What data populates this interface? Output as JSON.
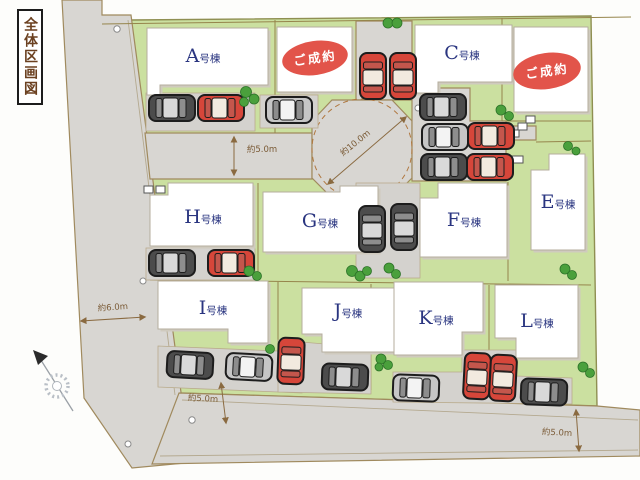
{
  "title": "全体区画図",
  "buildings": [
    {
      "letter": "A",
      "suffix": "号棟"
    },
    {
      "letter": "C",
      "suffix": "号棟"
    },
    {
      "letter": "E",
      "suffix": "号棟"
    },
    {
      "letter": "F",
      "suffix": "号棟"
    },
    {
      "letter": "G",
      "suffix": "号棟"
    },
    {
      "letter": "H",
      "suffix": "号棟"
    },
    {
      "letter": "I",
      "suffix": "号棟"
    },
    {
      "letter": "J",
      "suffix": "号棟"
    },
    {
      "letter": "K",
      "suffix": "号棟"
    },
    {
      "letter": "L",
      "suffix": "号棟"
    }
  ],
  "sold_badges": [
    {
      "label": "ご成約"
    },
    {
      "label": "ご成約"
    }
  ],
  "dimensions": {
    "top_road": "約5.0m",
    "turnaround": "約10.0m",
    "left_road": "約6.0m",
    "bottom_left_road": "約5.0m",
    "bottom_right_road": "約5.0m"
  },
  "colors": {
    "grass": "#cbe0a0",
    "road": "#d8d6d2",
    "sold_red": "#e2544a",
    "label_navy": "#2a3580",
    "boundary_olive": "#96854c",
    "dimension_brown": "#7a5a35",
    "car_red": "#d6463a",
    "car_dark": "#4c4c4c",
    "car_silver": "#c6c6c6",
    "tree_green": "#4aa03c"
  }
}
